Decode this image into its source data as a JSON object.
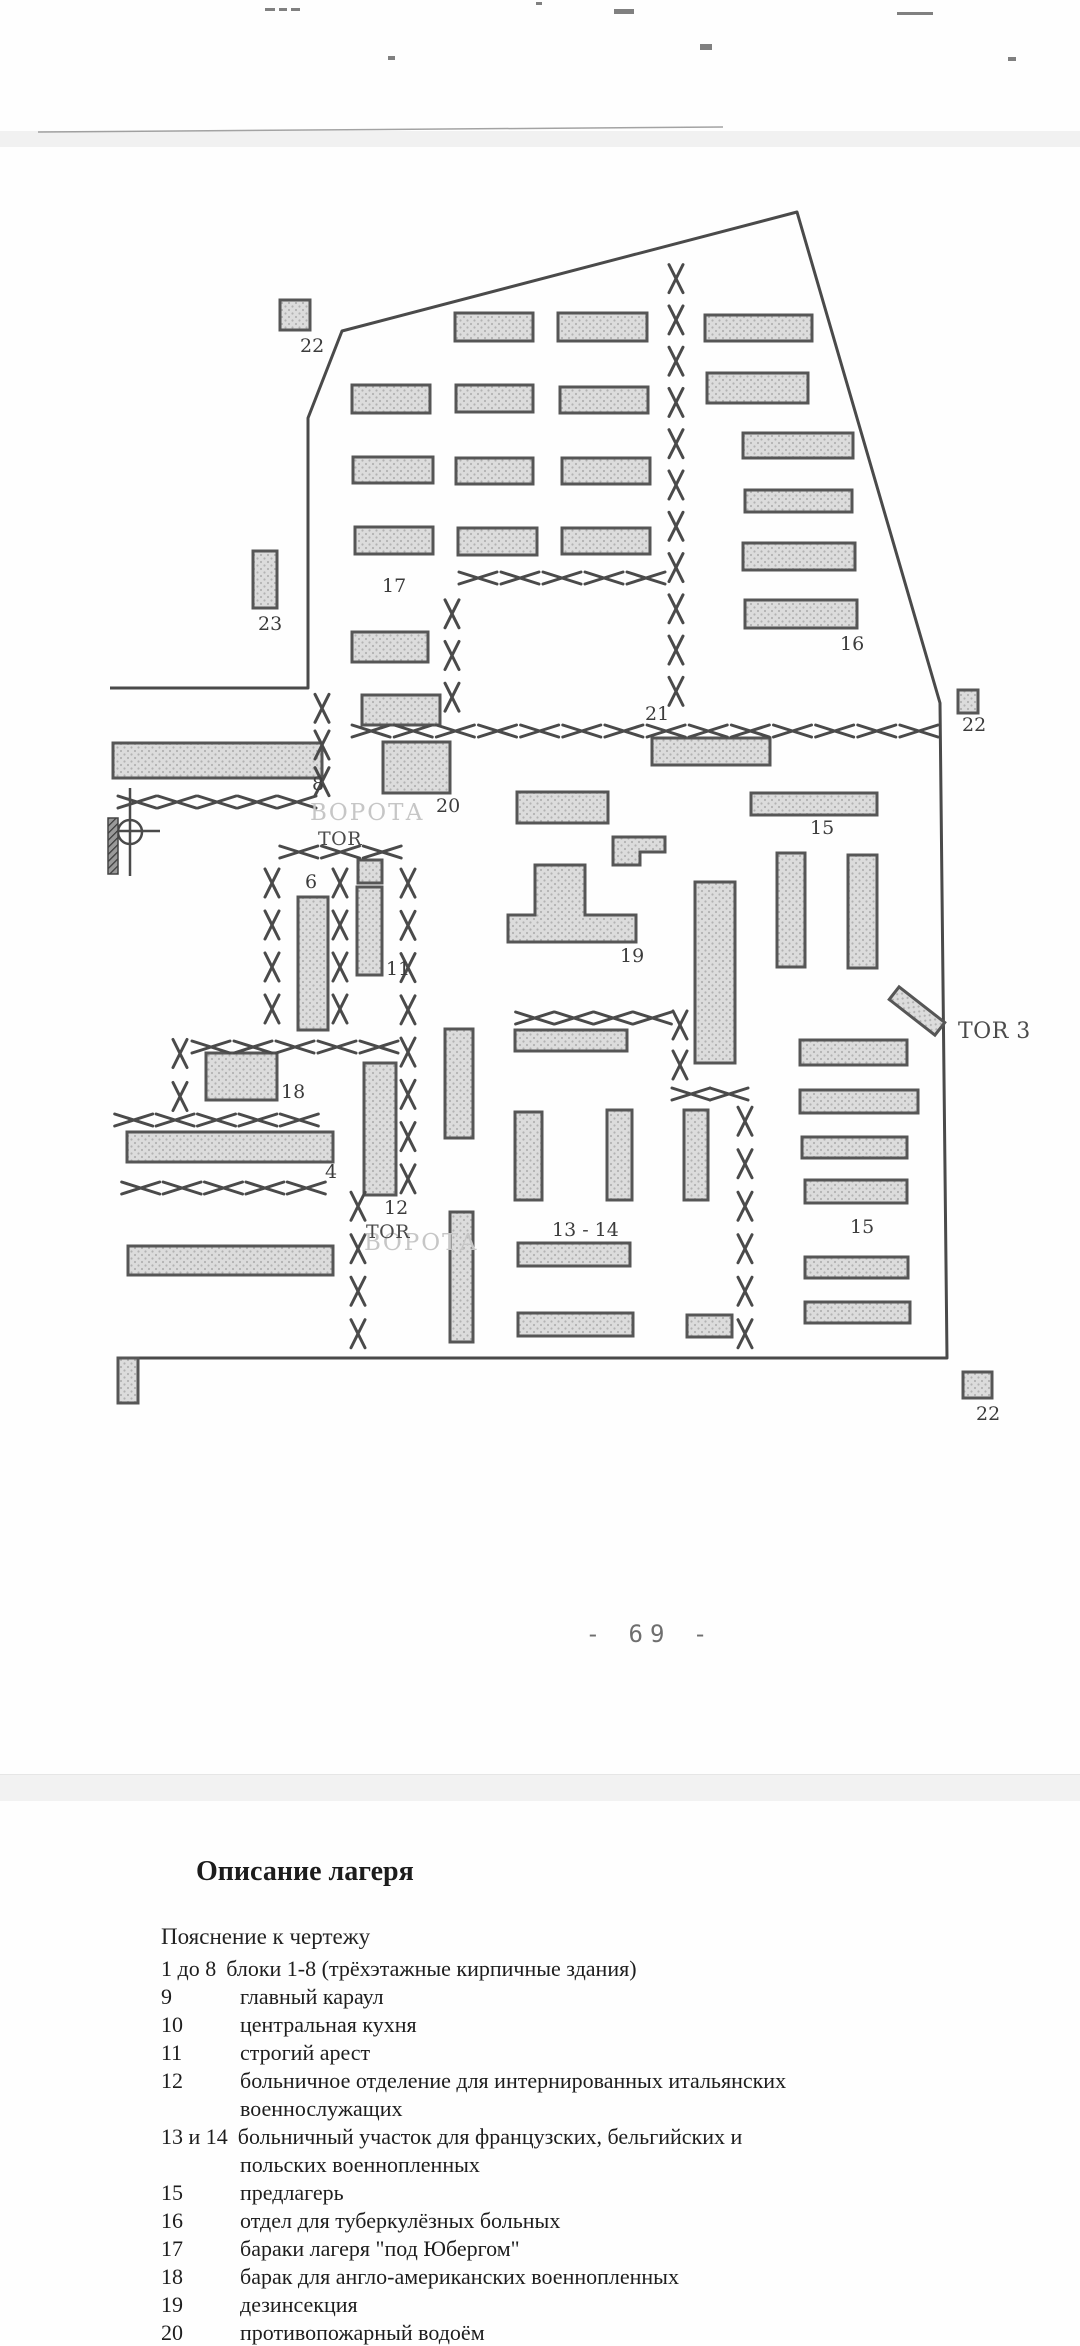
{
  "page": {
    "number_label": "- 69 -"
  },
  "colors": {
    "ink": "#4a4a4a",
    "building_fill": "#dcdcdc",
    "building_dot": "#b2b2b2",
    "building_border": "#565656",
    "label": "#3c3c3c",
    "faint_text": "#c6c6c6",
    "band": "#f2f2f2"
  },
  "map": {
    "boundary_points": "110,688 308,688 308,418 342,331 797,212 940,703 947,1358 118,1358",
    "buildings": [
      {
        "x": 352,
        "y": 385,
        "w": 78,
        "h": 28
      },
      {
        "x": 353,
        "y": 457,
        "w": 80,
        "h": 26
      },
      {
        "x": 355,
        "y": 527,
        "w": 78,
        "h": 27
      },
      {
        "x": 352,
        "y": 632,
        "w": 76,
        "h": 30
      },
      {
        "x": 362,
        "y": 695,
        "w": 78,
        "h": 30
      },
      {
        "x": 455,
        "y": 313,
        "w": 78,
        "h": 28
      },
      {
        "x": 456,
        "y": 385,
        "w": 77,
        "h": 27
      },
      {
        "x": 456,
        "y": 458,
        "w": 77,
        "h": 26
      },
      {
        "x": 458,
        "y": 528,
        "w": 79,
        "h": 27
      },
      {
        "x": 558,
        "y": 313,
        "w": 89,
        "h": 28
      },
      {
        "x": 560,
        "y": 387,
        "w": 88,
        "h": 26
      },
      {
        "x": 562,
        "y": 458,
        "w": 88,
        "h": 26
      },
      {
        "x": 562,
        "y": 528,
        "w": 88,
        "h": 26
      },
      {
        "x": 705,
        "y": 315,
        "w": 107,
        "h": 26
      },
      {
        "x": 707,
        "y": 373,
        "w": 101,
        "h": 30
      },
      {
        "x": 743,
        "y": 433,
        "w": 110,
        "h": 25
      },
      {
        "x": 745,
        "y": 490,
        "w": 107,
        "h": 22
      },
      {
        "x": 743,
        "y": 543,
        "w": 112,
        "h": 27
      },
      {
        "x": 745,
        "y": 600,
        "w": 112,
        "h": 28
      },
      {
        "x": 253,
        "y": 551,
        "w": 24,
        "h": 57
      },
      {
        "x": 280,
        "y": 300,
        "w": 30,
        "h": 30
      },
      {
        "x": 958,
        "y": 690,
        "w": 20,
        "h": 23
      },
      {
        "x": 963,
        "y": 1372,
        "w": 29,
        "h": 26
      },
      {
        "x": 113,
        "y": 743,
        "w": 209,
        "h": 35
      },
      {
        "x": 383,
        "y": 742,
        "w": 67,
        "h": 51
      },
      {
        "x": 652,
        "y": 738,
        "w": 118,
        "h": 27
      },
      {
        "x": 751,
        "y": 793,
        "w": 126,
        "h": 22
      },
      {
        "x": 517,
        "y": 792,
        "w": 91,
        "h": 31
      },
      {
        "x": 777,
        "y": 853,
        "w": 28,
        "h": 114
      },
      {
        "x": 848,
        "y": 855,
        "w": 29,
        "h": 113
      },
      {
        "x": 695,
        "y": 882,
        "w": 40,
        "h": 181
      },
      {
        "x": 515,
        "y": 1030,
        "w": 112,
        "h": 21
      },
      {
        "x": 298,
        "y": 897,
        "w": 30,
        "h": 133
      },
      {
        "x": 358,
        "y": 860,
        "w": 24,
        "h": 23
      },
      {
        "x": 357,
        "y": 887,
        "w": 25,
        "h": 88
      },
      {
        "x": 206,
        "y": 1053,
        "w": 71,
        "h": 47
      },
      {
        "x": 127,
        "y": 1132,
        "w": 206,
        "h": 30
      },
      {
        "x": 128,
        "y": 1246,
        "w": 205,
        "h": 29
      },
      {
        "x": 364,
        "y": 1063,
        "w": 32,
        "h": 132
      },
      {
        "x": 445,
        "y": 1029,
        "w": 28,
        "h": 109
      },
      {
        "x": 450,
        "y": 1212,
        "w": 23,
        "h": 130
      },
      {
        "x": 515,
        "y": 1112,
        "w": 27,
        "h": 88
      },
      {
        "x": 518,
        "y": 1243,
        "w": 112,
        "h": 23
      },
      {
        "x": 518,
        "y": 1313,
        "w": 115,
        "h": 23
      },
      {
        "x": 687,
        "y": 1315,
        "w": 45,
        "h": 22
      },
      {
        "x": 607,
        "y": 1110,
        "w": 25,
        "h": 90
      },
      {
        "x": 684,
        "y": 1110,
        "w": 24,
        "h": 90
      },
      {
        "x": 800,
        "y": 1040,
        "w": 107,
        "h": 25
      },
      {
        "x": 800,
        "y": 1090,
        "w": 118,
        "h": 23
      },
      {
        "x": 802,
        "y": 1137,
        "w": 105,
        "h": 21
      },
      {
        "x": 805,
        "y": 1180,
        "w": 102,
        "h": 23
      },
      {
        "x": 805,
        "y": 1257,
        "w": 103,
        "h": 21
      },
      {
        "x": 805,
        "y": 1302,
        "w": 105,
        "h": 21
      },
      {
        "x": 118,
        "y": 1358,
        "w": 20,
        "h": 45
      },
      {
        "x": 888,
        "y": 1003,
        "w": 58,
        "h": 16,
        "rot": 38
      },
      {
        "pts": "613,837 665,837 665,852 640,852 640,865 613,865"
      },
      {
        "pts": "535,865 585,865 585,915 636,915 636,942 508,942 508,915 535,915"
      }
    ],
    "fences": [
      {
        "o": "h",
        "x": 457,
        "y": 578,
        "len": 210
      },
      {
        "o": "v",
        "x": 676,
        "y": 258,
        "len": 454
      },
      {
        "o": "v",
        "x": 452,
        "y": 593,
        "len": 125
      },
      {
        "o": "v",
        "x": 322,
        "y": 690,
        "len": 110
      },
      {
        "o": "h",
        "x": 350,
        "y": 731,
        "len": 590
      },
      {
        "o": "h",
        "x": 117,
        "y": 802,
        "len": 200
      },
      {
        "o": "h",
        "x": 278,
        "y": 852,
        "len": 125
      },
      {
        "o": "v",
        "x": 272,
        "y": 862,
        "len": 168
      },
      {
        "o": "v",
        "x": 340,
        "y": 862,
        "len": 168
      },
      {
        "o": "v",
        "x": 408,
        "y": 862,
        "len": 338
      },
      {
        "o": "h",
        "x": 190,
        "y": 1047,
        "len": 210
      },
      {
        "o": "v",
        "x": 180,
        "y": 1032,
        "len": 86
      },
      {
        "o": "h",
        "x": 113,
        "y": 1120,
        "len": 207
      },
      {
        "o": "h",
        "x": 120,
        "y": 1188,
        "len": 207
      },
      {
        "o": "v",
        "x": 358,
        "y": 1185,
        "len": 170
      },
      {
        "o": "h",
        "x": 515,
        "y": 1018,
        "len": 157
      },
      {
        "o": "v",
        "x": 680,
        "y": 1005,
        "len": 80
      },
      {
        "o": "h",
        "x": 672,
        "y": 1094,
        "len": 76
      },
      {
        "o": "v",
        "x": 745,
        "y": 1100,
        "len": 255
      }
    ],
    "labels": [
      {
        "t": "22",
        "x": 300,
        "y": 352
      },
      {
        "t": "23",
        "x": 258,
        "y": 630
      },
      {
        "t": "17",
        "x": 382,
        "y": 592
      },
      {
        "t": "16",
        "x": 840,
        "y": 650
      },
      {
        "t": "21",
        "x": 645,
        "y": 720
      },
      {
        "t": "8",
        "x": 312,
        "y": 790
      },
      {
        "t": "20",
        "x": 436,
        "y": 812
      },
      {
        "t": "6",
        "x": 305,
        "y": 888
      },
      {
        "t": "11",
        "x": 386,
        "y": 975
      },
      {
        "t": "19",
        "x": 620,
        "y": 962
      },
      {
        "t": "15",
        "x": 810,
        "y": 834
      },
      {
        "t": "18",
        "x": 281,
        "y": 1098
      },
      {
        "t": "4",
        "x": 325,
        "y": 1178
      },
      {
        "t": "12",
        "x": 384,
        "y": 1214
      },
      {
        "t": "13 - 14",
        "x": 552,
        "y": 1236
      },
      {
        "t": "15",
        "x": 850,
        "y": 1233
      },
      {
        "t": "22",
        "x": 962,
        "y": 731
      },
      {
        "t": "22",
        "x": 976,
        "y": 1420
      }
    ],
    "gate_labels": [
      {
        "t": "ВОРОТА",
        "x": 310,
        "y": 820,
        "faint": true,
        "size": 23
      },
      {
        "t": "TOR",
        "x": 318,
        "y": 845,
        "size": 19
      },
      {
        "t": "ВОРОТА",
        "x": 364,
        "y": 1250,
        "faint": true,
        "size": 23
      },
      {
        "t": "TOR",
        "x": 366,
        "y": 1238,
        "size": 19
      },
      {
        "t": "TOR 3",
        "x": 958,
        "y": 1038,
        "size": 22
      }
    ],
    "well_symbol": {
      "cx": 130,
      "cy": 832,
      "r": 12,
      "vy1": 788,
      "vy2": 876,
      "hx1": 112,
      "hx2": 160,
      "bar": {
        "x": 108,
        "y": 818,
        "w": 10,
        "h": 56
      }
    },
    "scan_line": {
      "x1": 38,
      "y1": 132,
      "x2": 723,
      "y2": 127
    },
    "artifacts": [
      {
        "x": 265,
        "y": 8,
        "w": 10,
        "h": 3
      },
      {
        "x": 279,
        "y": 8,
        "w": 8,
        "h": 3
      },
      {
        "x": 291,
        "y": 8,
        "w": 9,
        "h": 3
      },
      {
        "x": 614,
        "y": 9,
        "w": 20,
        "h": 5
      },
      {
        "x": 897,
        "y": 12,
        "w": 36,
        "h": 3
      },
      {
        "x": 388,
        "y": 56,
        "w": 7,
        "h": 4
      },
      {
        "x": 700,
        "y": 44,
        "w": 12,
        "h": 6
      },
      {
        "x": 1008,
        "y": 57,
        "w": 8,
        "h": 4
      },
      {
        "x": 536,
        "y": 2,
        "w": 6,
        "h": 3
      }
    ]
  },
  "legend": {
    "title": "Описание лагеря",
    "subtitle": "Пояснение к чертежу",
    "items": [
      {
        "num": "1 до 8",
        "text": "блоки 1-8 (трёхэтажные кирпичные здания)",
        "runin": true
      },
      {
        "num": "9",
        "text": "главный караул"
      },
      {
        "num": "10",
        "text": "центральная кухня"
      },
      {
        "num": "11",
        "text": "строгий арест"
      },
      {
        "num": "12",
        "text": "больничное отделение для интернированных итальянских"
      },
      {
        "num": "",
        "text": "военнослужащих",
        "indent": true
      },
      {
        "num": "13 и 14",
        "text": "больничный участок для французских, бельгийских и",
        "runin": true
      },
      {
        "num": "",
        "text": "польских военнопленных",
        "indent": true
      },
      {
        "num": "15",
        "text": "предлагерь"
      },
      {
        "num": "16",
        "text": "отдел для туберкулёзных больных"
      },
      {
        "num": "17",
        "text": "бараки лагеря \"под Юбергом\""
      },
      {
        "num": "18",
        "text": "барак для англо-американских военнопленных"
      },
      {
        "num": "19",
        "text": "дезинсекция"
      },
      {
        "num": "20",
        "text": "противопожарный водоём"
      }
    ]
  }
}
